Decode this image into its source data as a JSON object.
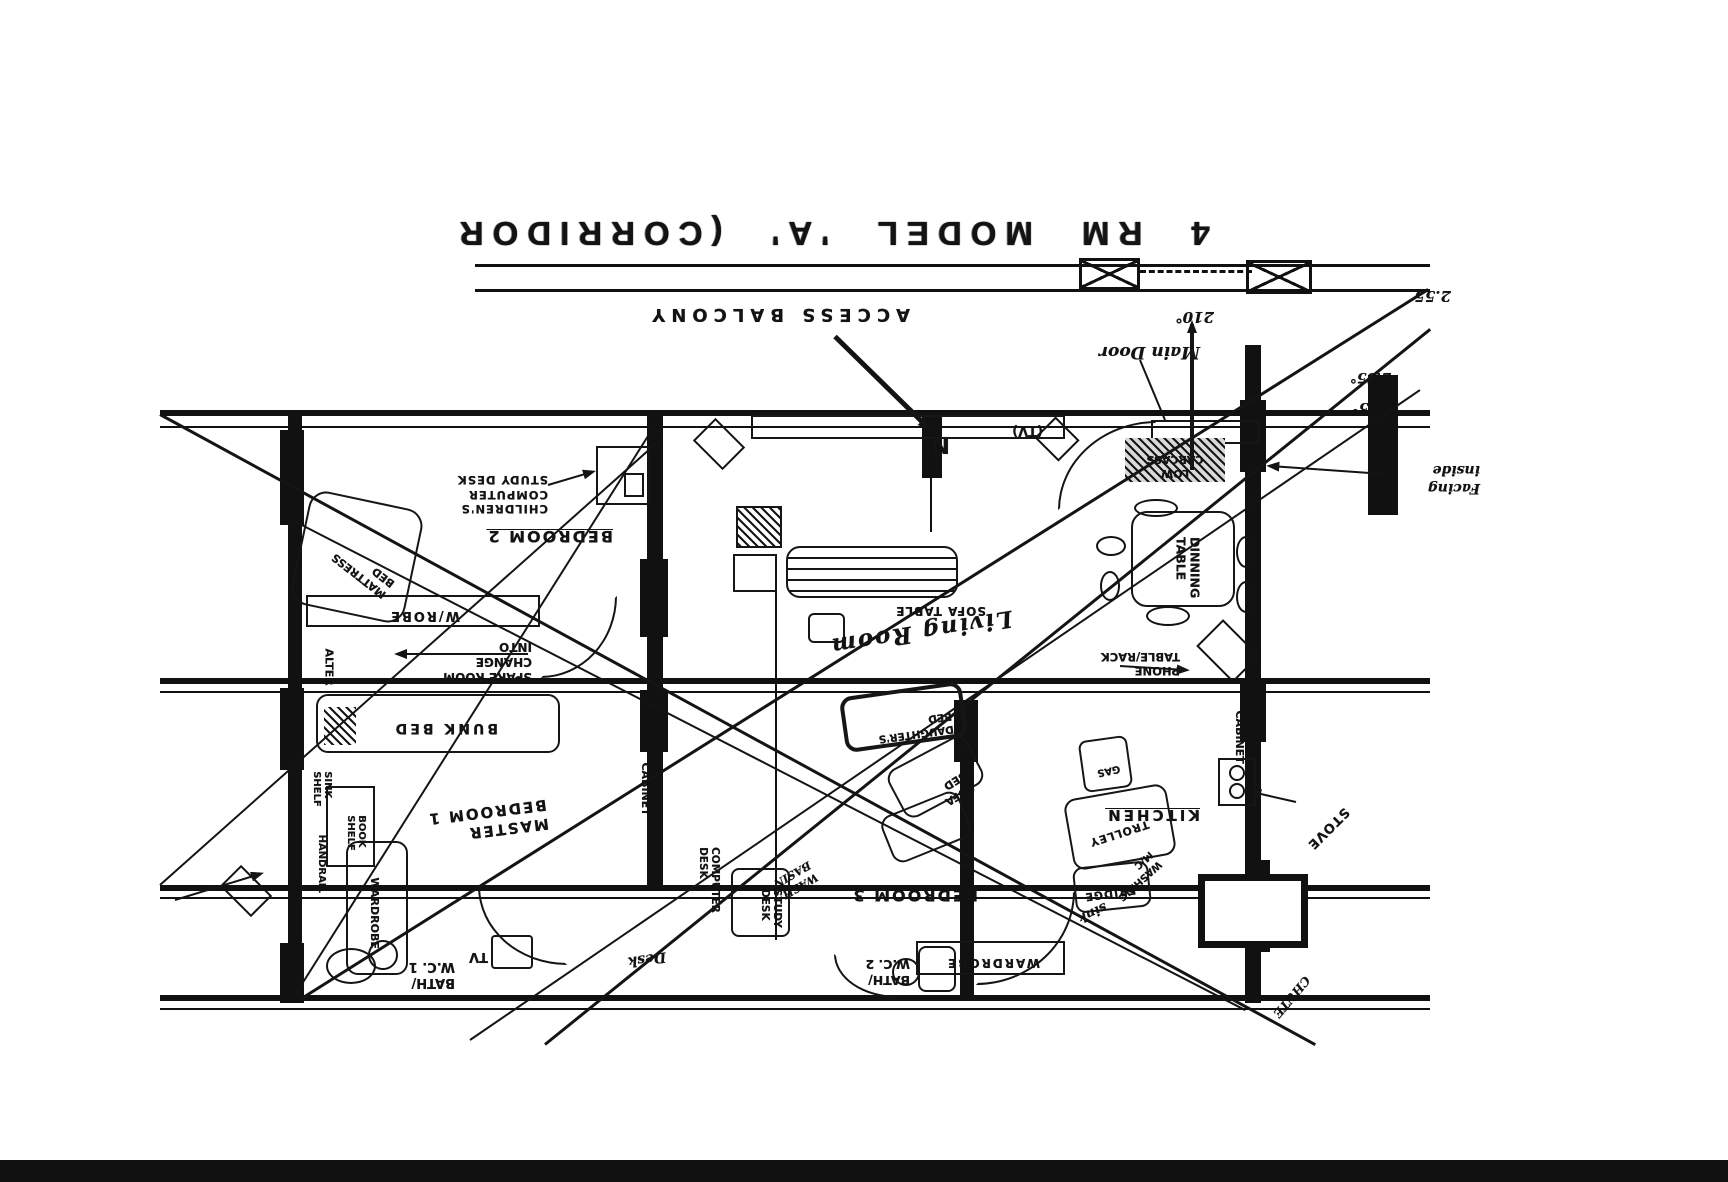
{
  "title": "4 RM MODEL 'A' (CORRIDOR",
  "corridor": {
    "access_balcony": "ACCESS BALCONY"
  },
  "annotations": {
    "main_door": "Main Door",
    "north": "N",
    "angle_210": "210°",
    "dim_255": "2.55",
    "dim_255a": "2.55°",
    "dim_255b": "2.55°",
    "facing_inside": "Facing\ninside",
    "low_carcass": "LOW\nCARCASS",
    "tv_console": "(TV)"
  },
  "bedroom2": {
    "name": "BEDROOM 2",
    "children_desk": "CHILDREN'S\nCOMPUTER\nSTUDY DESK",
    "mattress_bed": "MATTRESS\nBED",
    "wrobe": "W/ROBE",
    "spare_room": "SPARE ROOM\nCHANGE\nINTO",
    "alter": "ALTER"
  },
  "master": {
    "name": "MASTER\nBEDROOM 1",
    "bunk_bed": "BUNK BED",
    "book_shelf": "BOOK\nSHELF",
    "sink_shelf": "SINK\nSHELF",
    "handrail": "HANDRAIL",
    "wardrobe": "WARDROBE",
    "tv": "TV",
    "bath1": "BATH/\nW.C. 1",
    "cabinet": "CABINET",
    "computer_desk": "COMPUTER\nDESK",
    "desk": "Desk"
  },
  "bedroom3": {
    "name": "BEDROOM 3",
    "study_desk": "STUDY\nDESK",
    "daughters_bed": "DAUGHTER'S\nBED",
    "sofa_bed": "SOFA\nBED",
    "wardrobe": "WARDROBE",
    "bath2": "BATH/\nW.C. 2",
    "wash_basin": "WASH\nBASIN"
  },
  "living": {
    "name": "Living Room",
    "sofa_table": "SOFA TABLE",
    "phone_rack": "PHONE\nTABLE/RACK"
  },
  "kitchen": {
    "name": "KITCHEN",
    "dining_table": "DINNING\nTABLE",
    "cabinet": "CABINET",
    "stove": "STOVE",
    "gas": "GAS",
    "trolley": "TROLLEY",
    "fridge": "FRIDGE",
    "sink": "sink",
    "washing_mc": "WASHING\nM/C",
    "chute": "CHUTE"
  }
}
